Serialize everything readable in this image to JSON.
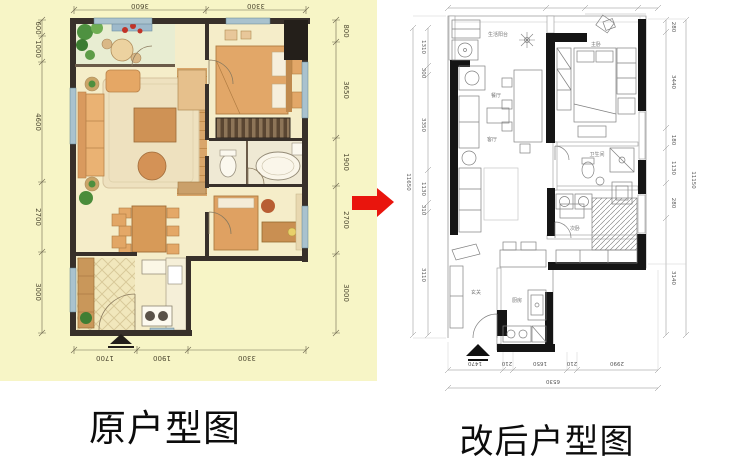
{
  "titles": {
    "left": "原户型图",
    "right": "改后户型图"
  },
  "arrow": {
    "name": "red-transform-arrow",
    "color": "#e9150d"
  },
  "left_panel": {
    "background": "#f7f5c6",
    "dims": {
      "top": [
        "3600",
        "3300"
      ],
      "bottom": [
        "1700",
        "1900",
        "3300"
      ],
      "left": [
        "600",
        "1000",
        "4600",
        "2700",
        "3000"
      ],
      "right": [
        "800",
        "3650",
        "1900",
        "2700",
        "3000"
      ]
    }
  },
  "right_panel": {
    "dims": {
      "left": [
        "1310",
        "300",
        "3350",
        "1130",
        "310",
        "3110"
      ],
      "left_overall": "11650",
      "right": [
        "280",
        "3440",
        "180",
        "1130",
        "280",
        "3140"
      ],
      "right_overall": "11150",
      "bottom": [
        "1470",
        "210",
        "1650",
        "210",
        "2990"
      ],
      "bottom_overall": "6530"
    },
    "room_labels": [
      "生活阳台",
      "餐厅",
      "客厅",
      "主卧",
      "卫生间",
      "玄关",
      "厨房",
      "次卧"
    ]
  }
}
